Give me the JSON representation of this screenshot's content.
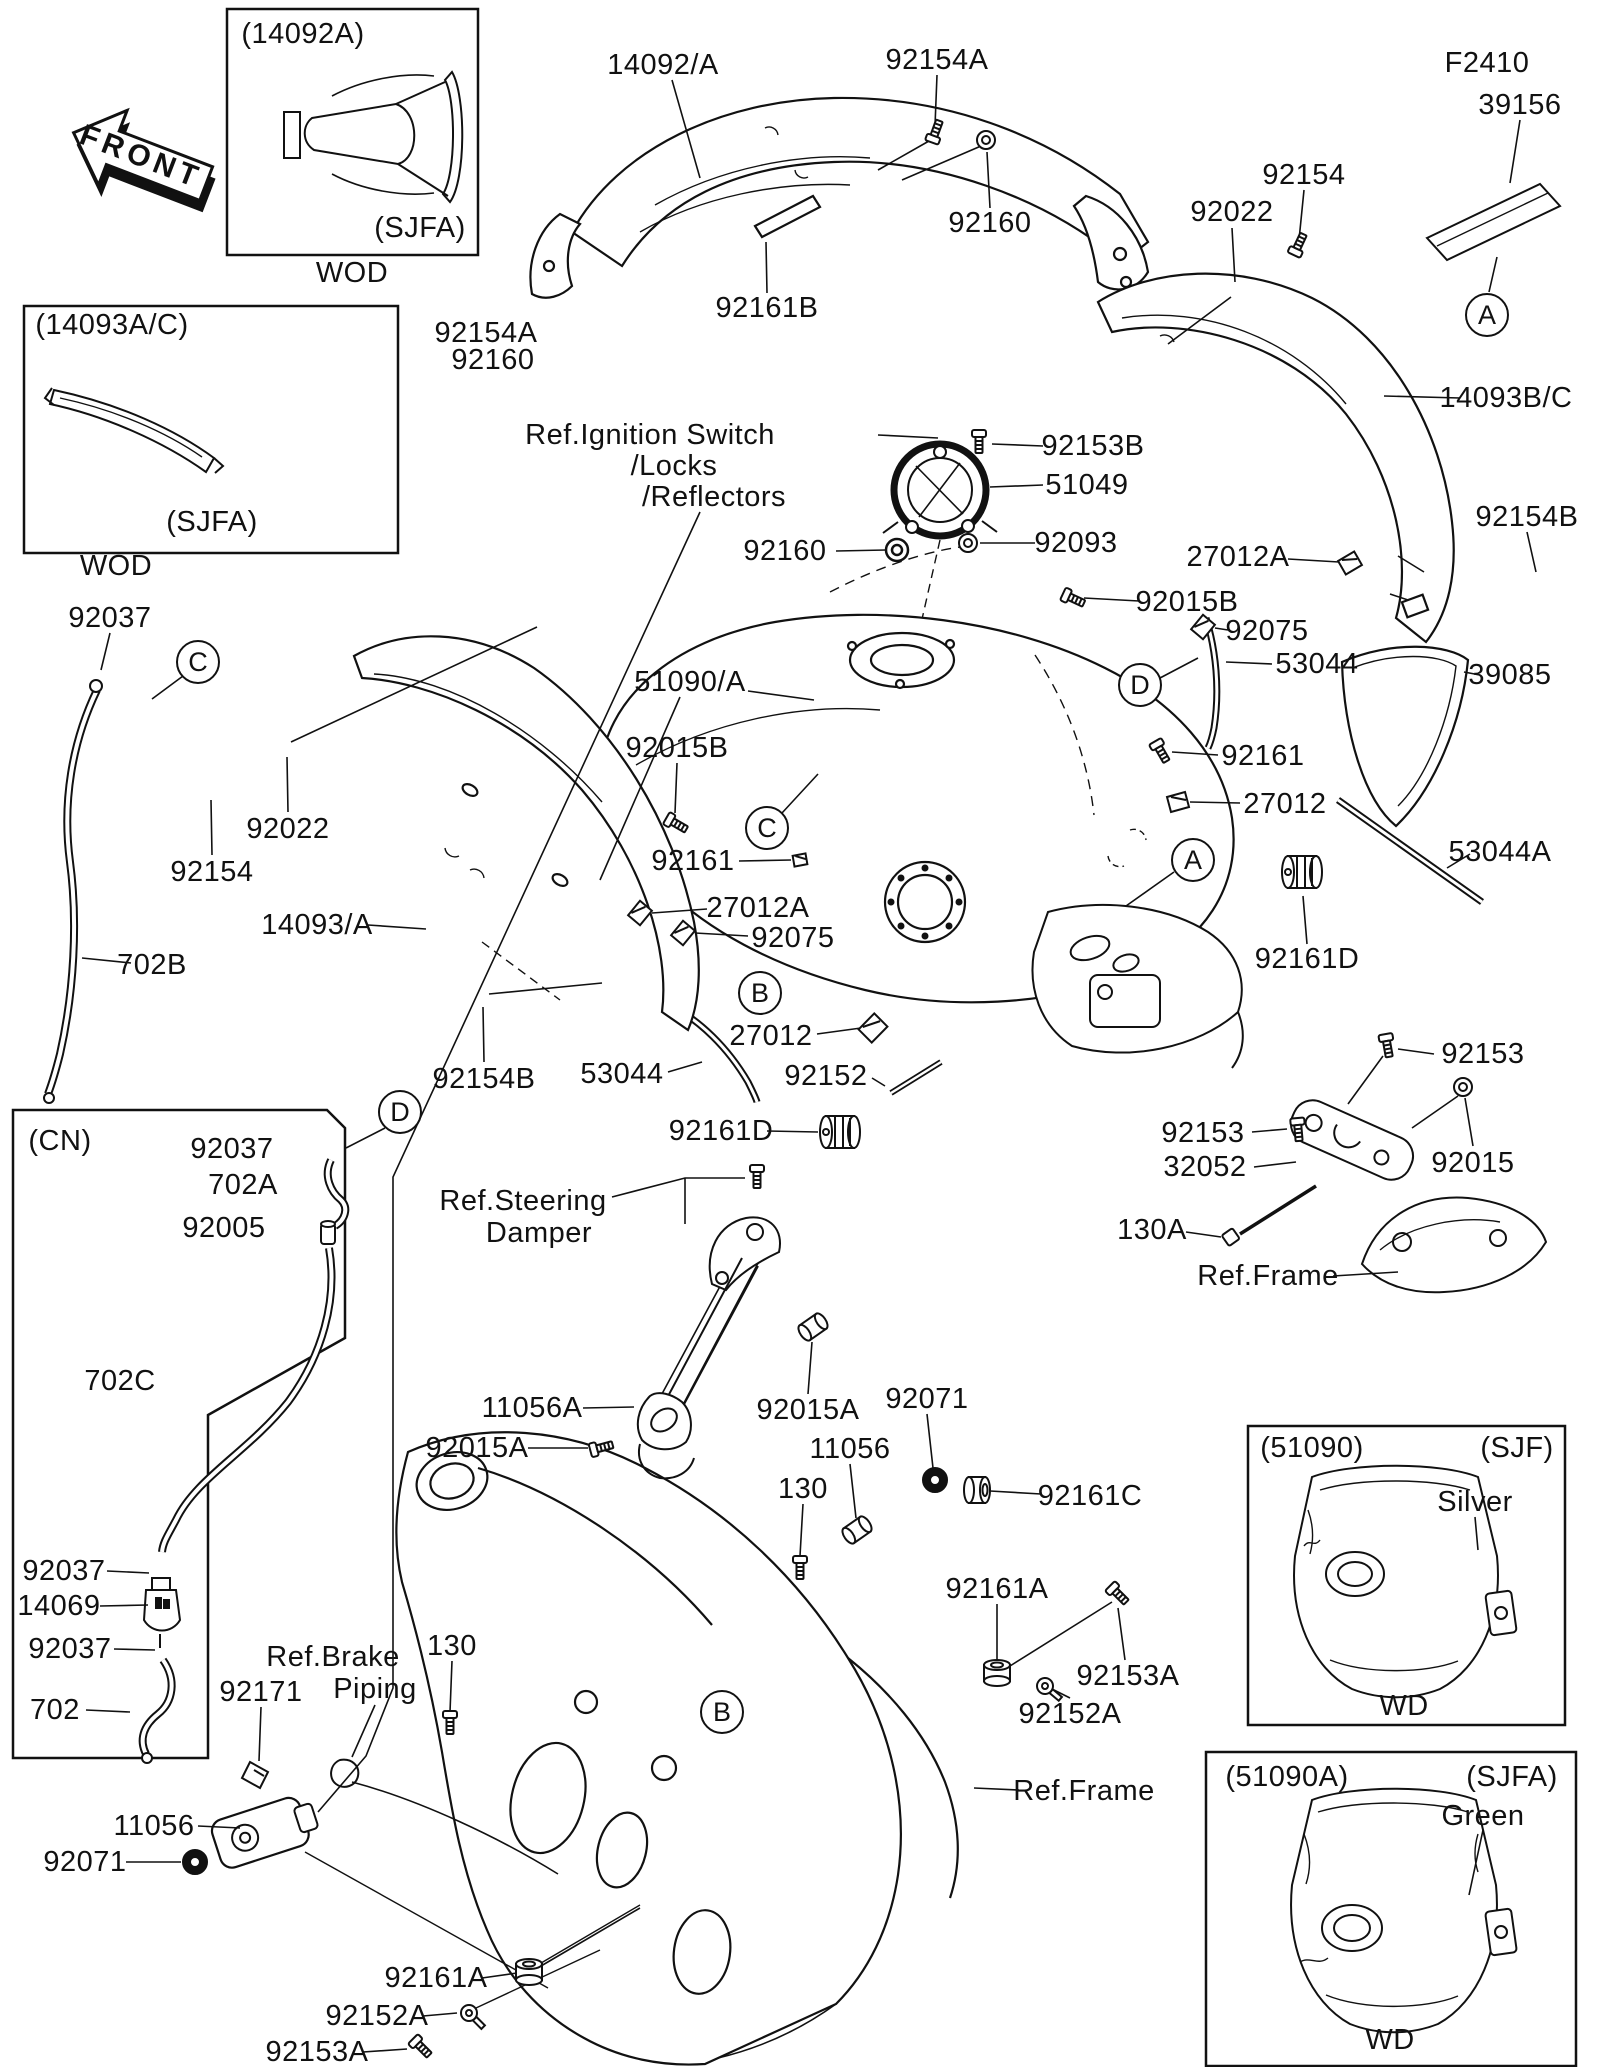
{
  "doc": {
    "kind": "parts-diagram",
    "subject": "Fuel Tank",
    "line_color": "#111111",
    "bg_color": "#ffffff"
  },
  "labels": [
    {
      "text": "FRONT",
      "x": 141,
      "y": 157,
      "rot": 21,
      "name": "front-arrow-label",
      "cls": "front"
    },
    {
      "text": "(14092A)",
      "x": 303,
      "y": 34,
      "name": "box-caption"
    },
    {
      "text": "(SJFA)",
      "x": 420,
      "y": 228,
      "name": "box-variant"
    },
    {
      "text": "WOD",
      "x": 352,
      "y": 273,
      "name": "box-footer"
    },
    {
      "text": "(14093A/C)",
      "x": 112,
      "y": 325,
      "name": "box-caption"
    },
    {
      "text": "(SJFA)",
      "x": 212,
      "y": 522,
      "name": "box-variant"
    },
    {
      "text": "WOD",
      "x": 116,
      "y": 566,
      "name": "box-footer"
    },
    {
      "text": "14092/A",
      "x": 663,
      "y": 65,
      "name": "part-label"
    },
    {
      "text": "92154A",
      "x": 937,
      "y": 60,
      "name": "part-label"
    },
    {
      "text": "92160",
      "x": 990,
      "y": 223,
      "name": "part-label"
    },
    {
      "text": "92022",
      "x": 1232,
      "y": 212,
      "name": "part-label"
    },
    {
      "text": "92154",
      "x": 1304,
      "y": 175,
      "name": "part-label"
    },
    {
      "text": "F2410",
      "x": 1487,
      "y": 63,
      "name": "part-label"
    },
    {
      "text": "39156",
      "x": 1520,
      "y": 105,
      "name": "part-label"
    },
    {
      "text": "14093B/C",
      "x": 1506,
      "y": 398,
      "name": "part-label"
    },
    {
      "text": "92154B",
      "x": 1527,
      "y": 517,
      "name": "part-label"
    },
    {
      "text": "92154A",
      "x": 486,
      "y": 333,
      "name": "part-label"
    },
    {
      "text": "92160",
      "x": 493,
      "y": 360,
      "name": "part-label"
    },
    {
      "text": "92161B",
      "x": 767,
      "y": 308,
      "name": "part-label"
    },
    {
      "text": "Ref.Ignition Switch",
      "x": 650,
      "y": 435,
      "name": "ref-label"
    },
    {
      "text": "/Locks",
      "x": 674,
      "y": 466,
      "name": "ref-label"
    },
    {
      "text": "/Reflectors",
      "x": 714,
      "y": 497,
      "name": "ref-label"
    },
    {
      "text": "92153B",
      "x": 1093,
      "y": 446,
      "name": "part-label"
    },
    {
      "text": "51049",
      "x": 1087,
      "y": 485,
      "name": "part-label"
    },
    {
      "text": "92093",
      "x": 1076,
      "y": 543,
      "name": "part-label"
    },
    {
      "text": "92160",
      "x": 785,
      "y": 551,
      "name": "part-label"
    },
    {
      "text": "27012A",
      "x": 1238,
      "y": 557,
      "name": "part-label"
    },
    {
      "text": "92015B",
      "x": 1187,
      "y": 602,
      "name": "part-label"
    },
    {
      "text": "92075",
      "x": 1267,
      "y": 631,
      "name": "part-label"
    },
    {
      "text": "53044",
      "x": 1317,
      "y": 664,
      "name": "part-label"
    },
    {
      "text": "39085",
      "x": 1510,
      "y": 675,
      "name": "part-label"
    },
    {
      "text": "92161",
      "x": 1263,
      "y": 756,
      "name": "part-label"
    },
    {
      "text": "27012",
      "x": 1285,
      "y": 804,
      "name": "part-label"
    },
    {
      "text": "53044A",
      "x": 1500,
      "y": 852,
      "name": "part-label"
    },
    {
      "text": "92161D",
      "x": 1307,
      "y": 959,
      "name": "part-label"
    },
    {
      "text": "92153",
      "x": 1483,
      "y": 1054,
      "name": "part-label"
    },
    {
      "text": "92153",
      "x": 1203,
      "y": 1133,
      "name": "part-label"
    },
    {
      "text": "32052",
      "x": 1205,
      "y": 1167,
      "name": "part-label"
    },
    {
      "text": "92015",
      "x": 1473,
      "y": 1163,
      "name": "part-label"
    },
    {
      "text": "130A",
      "x": 1152,
      "y": 1230,
      "name": "part-label"
    },
    {
      "text": "Ref.Frame",
      "x": 1268,
      "y": 1276,
      "name": "ref-label"
    },
    {
      "text": "92037",
      "x": 110,
      "y": 618,
      "name": "part-label"
    },
    {
      "text": "92022",
      "x": 288,
      "y": 829,
      "name": "part-label"
    },
    {
      "text": "92154",
      "x": 212,
      "y": 872,
      "name": "part-label"
    },
    {
      "text": "14093/A",
      "x": 317,
      "y": 925,
      "name": "part-label"
    },
    {
      "text": "702B",
      "x": 152,
      "y": 965,
      "name": "part-label"
    },
    {
      "text": "51090/A",
      "x": 690,
      "y": 682,
      "name": "part-label"
    },
    {
      "text": "92015B",
      "x": 677,
      "y": 748,
      "name": "part-label"
    },
    {
      "text": "92161",
      "x": 693,
      "y": 861,
      "name": "part-label"
    },
    {
      "text": "27012A",
      "x": 758,
      "y": 908,
      "name": "part-label"
    },
    {
      "text": "92075",
      "x": 793,
      "y": 938,
      "name": "part-label"
    },
    {
      "text": "27012",
      "x": 771,
      "y": 1036,
      "name": "part-label"
    },
    {
      "text": "53044",
      "x": 622,
      "y": 1074,
      "name": "part-label"
    },
    {
      "text": "92152",
      "x": 826,
      "y": 1076,
      "name": "part-label"
    },
    {
      "text": "92154B",
      "x": 484,
      "y": 1079,
      "name": "part-label"
    },
    {
      "text": "92161D",
      "x": 721,
      "y": 1131,
      "name": "part-label"
    },
    {
      "text": "(CN)",
      "x": 60,
      "y": 1141,
      "name": "box-caption"
    },
    {
      "text": "92037",
      "x": 232,
      "y": 1149,
      "name": "part-label"
    },
    {
      "text": "702A",
      "x": 243,
      "y": 1185,
      "name": "part-label"
    },
    {
      "text": "92005",
      "x": 224,
      "y": 1228,
      "name": "part-label"
    },
    {
      "text": "702C",
      "x": 120,
      "y": 1381,
      "name": "part-label"
    },
    {
      "text": "Ref.Steering",
      "x": 523,
      "y": 1201,
      "name": "ref-label"
    },
    {
      "text": "Damper",
      "x": 539,
      "y": 1233,
      "name": "ref-label"
    },
    {
      "text": "11056A",
      "x": 532,
      "y": 1408,
      "name": "part-label"
    },
    {
      "text": "92015A",
      "x": 477,
      "y": 1448,
      "name": "part-label"
    },
    {
      "text": "92015A",
      "x": 808,
      "y": 1410,
      "name": "part-label"
    },
    {
      "text": "92071",
      "x": 927,
      "y": 1399,
      "name": "part-label"
    },
    {
      "text": "11056",
      "x": 850,
      "y": 1449,
      "name": "part-label"
    },
    {
      "text": "130",
      "x": 803,
      "y": 1489,
      "name": "part-label"
    },
    {
      "text": "92161C",
      "x": 1090,
      "y": 1496,
      "name": "part-label"
    },
    {
      "text": "92161A",
      "x": 997,
      "y": 1589,
      "name": "part-label"
    },
    {
      "text": "92153A",
      "x": 1128,
      "y": 1676,
      "name": "part-label"
    },
    {
      "text": "92152A",
      "x": 1070,
      "y": 1714,
      "name": "part-label"
    },
    {
      "text": "92037",
      "x": 64,
      "y": 1571,
      "name": "part-label"
    },
    {
      "text": "14069",
      "x": 59,
      "y": 1606,
      "name": "part-label"
    },
    {
      "text": "92037",
      "x": 70,
      "y": 1649,
      "name": "part-label"
    },
    {
      "text": "702",
      "x": 55,
      "y": 1710,
      "name": "part-label"
    },
    {
      "text": "Ref.Brake",
      "x": 333,
      "y": 1657,
      "name": "ref-label"
    },
    {
      "text": "Piping",
      "x": 375,
      "y": 1689,
      "name": "ref-label"
    },
    {
      "text": "92171",
      "x": 261,
      "y": 1692,
      "name": "part-label"
    },
    {
      "text": "130",
      "x": 452,
      "y": 1646,
      "name": "part-label"
    },
    {
      "text": "11056",
      "x": 154,
      "y": 1826,
      "name": "part-label"
    },
    {
      "text": "92071",
      "x": 85,
      "y": 1862,
      "name": "part-label"
    },
    {
      "text": "Ref.Frame",
      "x": 1084,
      "y": 1791,
      "name": "ref-label"
    },
    {
      "text": "92161A",
      "x": 436,
      "y": 1978,
      "name": "part-label"
    },
    {
      "text": "92152A",
      "x": 377,
      "y": 2016,
      "name": "part-label"
    },
    {
      "text": "92153A",
      "x": 317,
      "y": 2052,
      "name": "part-label"
    },
    {
      "text": "(51090)",
      "x": 1312,
      "y": 1448,
      "name": "box-caption"
    },
    {
      "text": "(SJF)",
      "x": 1517,
      "y": 1448,
      "name": "box-variant"
    },
    {
      "text": "Silver",
      "x": 1475,
      "y": 1502,
      "name": "color-label"
    },
    {
      "text": "WD",
      "x": 1404,
      "y": 1706,
      "name": "box-footer"
    },
    {
      "text": "(51090A)",
      "x": 1287,
      "y": 1777,
      "name": "box-caption"
    },
    {
      "text": "(SJFA)",
      "x": 1512,
      "y": 1777,
      "name": "box-variant"
    },
    {
      "text": "Green",
      "x": 1483,
      "y": 1816,
      "name": "color-label"
    },
    {
      "text": "WD",
      "x": 1390,
      "y": 2040,
      "name": "box-footer"
    }
  ],
  "circled_refs": [
    {
      "letter": "A",
      "x": 1487,
      "y": 315
    },
    {
      "letter": "A",
      "x": 1193,
      "y": 860
    },
    {
      "letter": "B",
      "x": 760,
      "y": 993
    },
    {
      "letter": "B",
      "x": 722,
      "y": 1712
    },
    {
      "letter": "C",
      "x": 198,
      "y": 662
    },
    {
      "letter": "C",
      "x": 767,
      "y": 828
    },
    {
      "letter": "D",
      "x": 1140,
      "y": 685
    },
    {
      "letter": "D",
      "x": 400,
      "y": 1112
    }
  ],
  "part_icons": [
    {
      "i": "screw",
      "x": 935,
      "y": 133,
      "r": -70
    },
    {
      "i": "nut",
      "x": 986,
      "y": 140,
      "r": 0
    },
    {
      "i": "boltdot",
      "x": 1235,
      "y": 291,
      "r": 0
    },
    {
      "i": "screw",
      "x": 1298,
      "y": 246,
      "r": -65
    },
    {
      "i": "screw",
      "x": 979,
      "y": 440,
      "r": 90
    },
    {
      "i": "nut",
      "x": 968,
      "y": 543,
      "r": 0
    },
    {
      "i": "grom",
      "x": 897,
      "y": 550,
      "r": 0
    },
    {
      "i": "clip",
      "x": 1350,
      "y": 563,
      "r": -15
    },
    {
      "i": "screw",
      "x": 1072,
      "y": 598,
      "r": 25
    },
    {
      "i": "clip",
      "x": 1203,
      "y": 627,
      "r": -35
    },
    {
      "i": "screw",
      "x": 1160,
      "y": 750,
      "r": 60
    },
    {
      "i": "clip",
      "x": 1178,
      "y": 802,
      "r": 0
    },
    {
      "i": "knob",
      "x": 1302,
      "y": 872,
      "r": 0
    },
    {
      "i": "screw",
      "x": 1387,
      "y": 1044,
      "r": 80
    },
    {
      "i": "nut",
      "x": 1463,
      "y": 1087,
      "r": 0
    },
    {
      "i": "screw",
      "x": 1298,
      "y": 1128,
      "r": 85
    },
    {
      "i": "screw",
      "x": 675,
      "y": 823,
      "r": 30
    },
    {
      "i": "clip",
      "x": 800,
      "y": 860,
      "r": 5,
      "s": 0.7
    },
    {
      "i": "clip",
      "x": 640,
      "y": 913,
      "r": -35
    },
    {
      "i": "clip",
      "x": 683,
      "y": 933,
      "r": -35
    },
    {
      "i": "clip",
      "x": 873,
      "y": 1028,
      "r": -30,
      "s": 1.2
    },
    {
      "i": "boltdot",
      "x": 483,
      "y": 998,
      "r": 0
    },
    {
      "i": "knob",
      "x": 840,
      "y": 1132,
      "r": 0
    },
    {
      "i": "screw",
      "x": 757,
      "y": 1175,
      "r": 90
    },
    {
      "i": "screw",
      "x": 600,
      "y": 1448,
      "r": -15
    },
    {
      "i": "collar",
      "x": 813,
      "y": 1327,
      "r": -35
    },
    {
      "i": "gromdark",
      "x": 935,
      "y": 1480,
      "r": 0
    },
    {
      "i": "collar",
      "x": 857,
      "y": 1530,
      "r": -35
    },
    {
      "i": "screw",
      "x": 800,
      "y": 1566,
      "r": 90
    },
    {
      "i": "bush",
      "x": 977,
      "y": 1490,
      "r": 90
    },
    {
      "i": "bush",
      "x": 997,
      "y": 1673,
      "r": 0
    },
    {
      "i": "screw",
      "x": 1117,
      "y": 1593,
      "r": 45
    },
    {
      "i": "wbolt",
      "x": 1045,
      "y": 1686,
      "r": 40
    },
    {
      "i": "gromdark",
      "x": 195,
      "y": 1862,
      "r": 0
    },
    {
      "i": "bush",
      "x": 529,
      "y": 1972,
      "r": 0
    },
    {
      "i": "wbolt",
      "x": 469,
      "y": 2013,
      "r": 45
    },
    {
      "i": "screw",
      "x": 420,
      "y": 2046,
      "r": 45
    },
    {
      "i": "screw",
      "x": 450,
      "y": 1721,
      "r": 90
    },
    {
      "i": "boltdot",
      "x": 337,
      "y": 1152,
      "r": 0
    },
    {
      "i": "boltdot",
      "x": 163,
      "y": 1573,
      "r": 0
    },
    {
      "i": "boltdot",
      "x": 163,
      "y": 1652,
      "r": 0
    }
  ]
}
